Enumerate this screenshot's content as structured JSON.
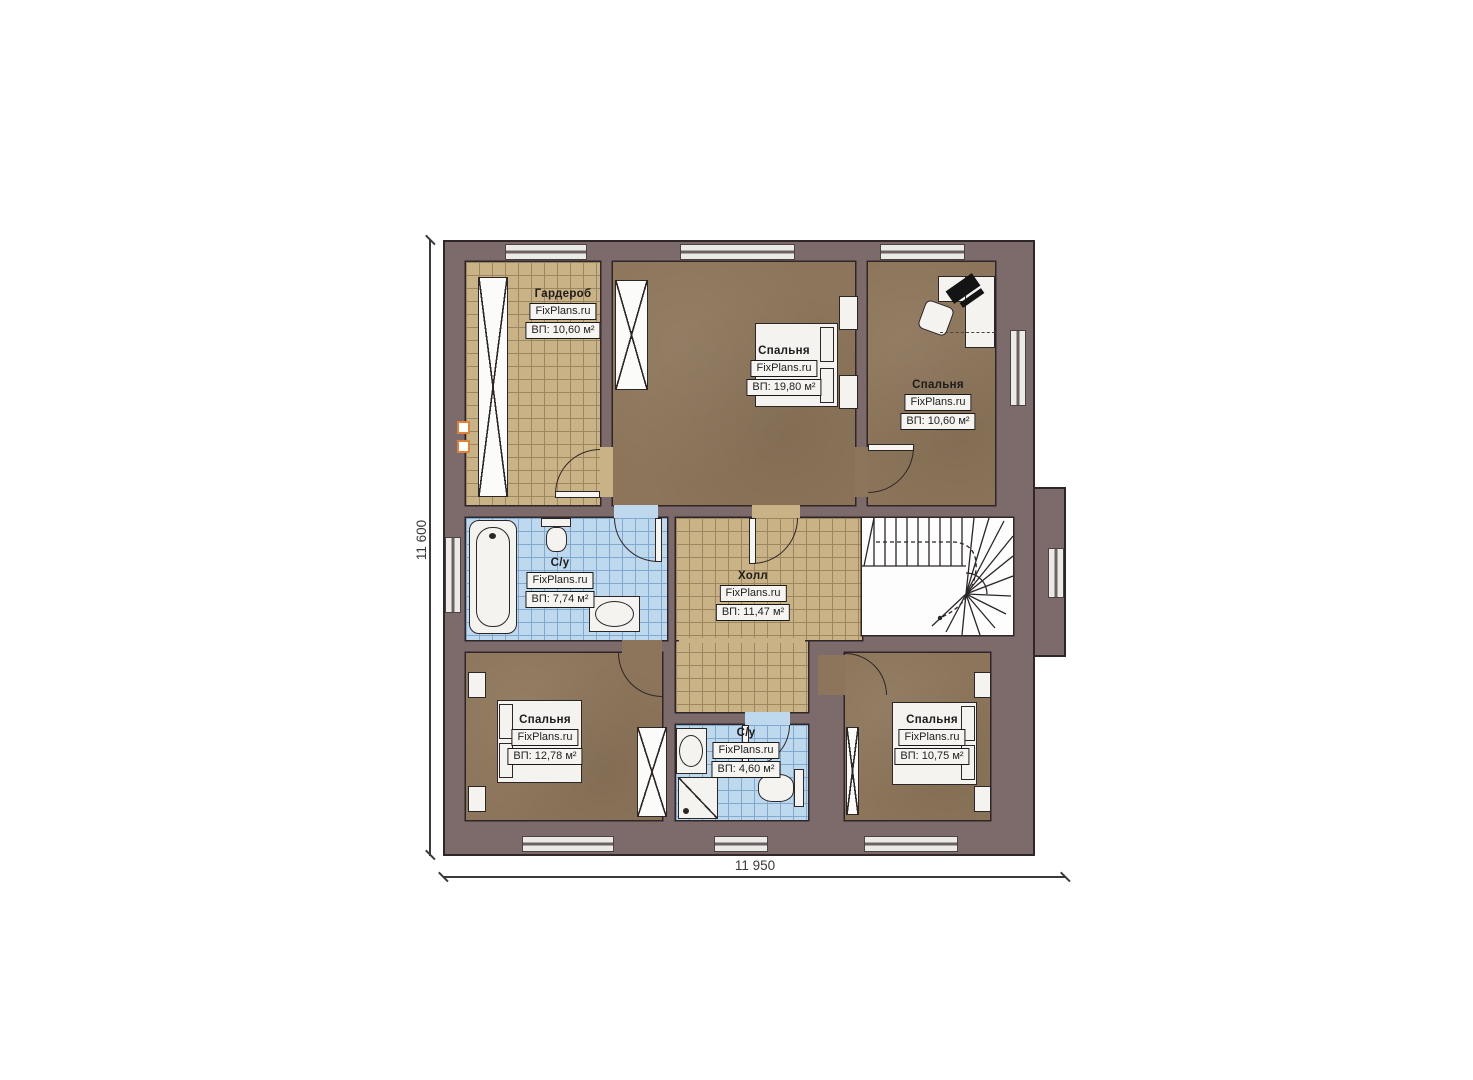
{
  "watermark": "FixPlans.ru",
  "rooms": [
    {
      "name": "Гардероб",
      "area": "ВП: 10,60 м²"
    },
    {
      "name": "Спальня",
      "area": "ВП: 19,80 м²"
    },
    {
      "name": "Спальня",
      "area": "ВП: 10,60 м²"
    },
    {
      "name": "С/у",
      "area": "ВП: 7,74 м²"
    },
    {
      "name": "Холл",
      "area": "ВП: 11,47 м²"
    },
    {
      "name": "Спальня",
      "area": "ВП: 12,78 м²"
    },
    {
      "name": "С/у",
      "area": "ВП: 4,60 м²"
    },
    {
      "name": "Спальня",
      "area": "ВП: 10,75 м²"
    }
  ],
  "dimensions": {
    "height_label": "11 600",
    "width_label": "11 950"
  },
  "colors": {
    "wall": "#7d6a6b",
    "outline": "#2f2628",
    "floor-brown": "#8c755a",
    "tile-tan": "#c9b285",
    "tile-blue": "#bed8ee",
    "fixture": "#f4f3f0"
  }
}
